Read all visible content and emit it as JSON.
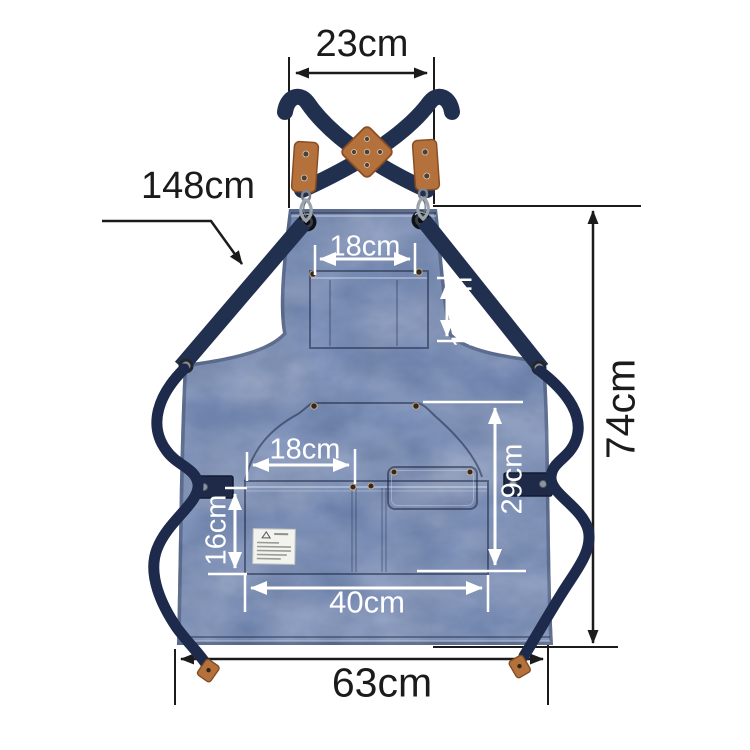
{
  "product": {
    "description": "Blue canvas cross-back work apron size diagram with navy straps and tan leather trims"
  },
  "colors": {
    "background": "#ffffff",
    "apron_canvas_blue": "#5b73a5",
    "strap_navy": "#22304f",
    "leather_tan": "#b4713c",
    "dimension_line_black": "#1b1b1b",
    "dimension_line_white": "#ffffff"
  },
  "dims": {
    "top_strap_width": "23cm",
    "strap_length": "148cm",
    "chest_pocket_width": "18cm",
    "chest_pocket_height": "12cm",
    "body_height": "74cm",
    "waist_pocket_width": "18cm",
    "lower_section_height": "29cm",
    "waist_pocket_height": "16cm",
    "pocket_panel_width": "40cm",
    "bottom_width": "63cm"
  }
}
